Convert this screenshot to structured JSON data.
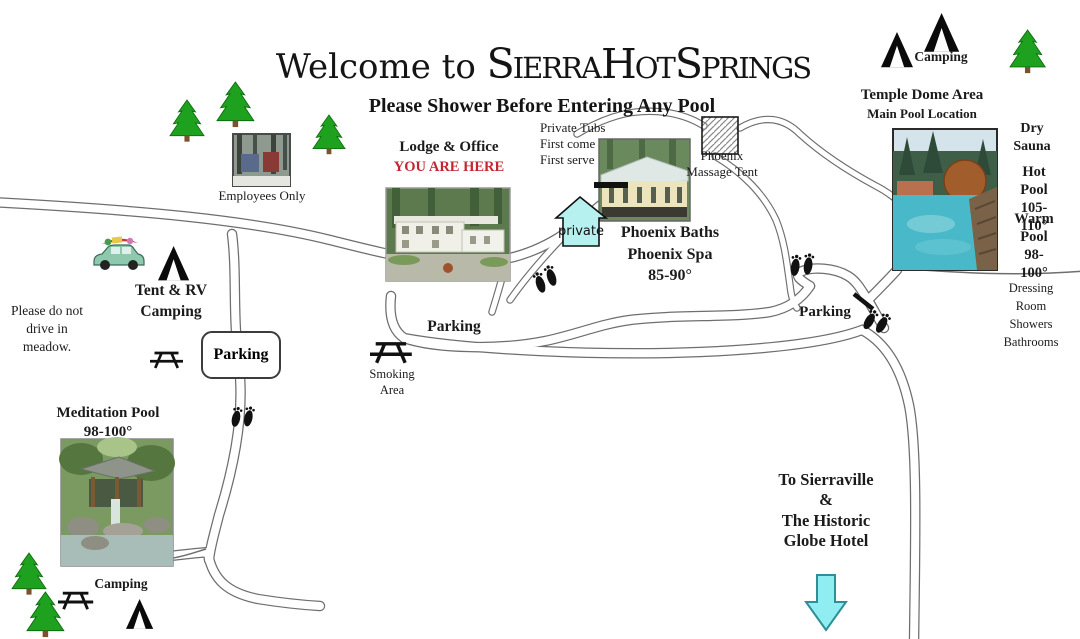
{
  "title": {
    "welcome": "Welcome to ",
    "resort": "Sierra Hot Springs"
  },
  "subtitle": "Please Shower Before Entering Any Pool",
  "areas": {
    "camping_top": "Camping",
    "temple_title": "Temple Dome Area",
    "temple_sub": "Main Pool Location",
    "dry_sauna": "Dry\nSauna",
    "hot_pool": "Hot Pool\n105-110°",
    "warm_pool": "Warm Pool\n98-100°",
    "dressing_rooms": "Dressing Room\nShowers\nBathrooms",
    "private_tubs": "Private Tubs\nFirst come\nFirst serve",
    "massage_tent": "Phoenix\nMassage Tent",
    "private_sign": "private",
    "phoenix_baths": "Phoenix Baths\nPhoenix Spa\n85-90°",
    "lodge_title": "Lodge & Office",
    "lodge_here": "YOU ARE HERE",
    "employees_only": "Employees Only",
    "tent_rv": "Tent & RV\nCamping",
    "meadow_note": "Please do not\ndrive in\nmeadow.",
    "parking_box": "Parking",
    "parking_center": "Parking",
    "parking_right": "Parking",
    "smoking_area": "Smoking\nArea",
    "meditation_pool": "Meditation Pool\n98-100°",
    "camping_bottom": "Camping",
    "sierraville": "To Sierraville\n&\nThe Historic\nGlobe Hotel"
  },
  "icons": {
    "tent_icon": "black tent triangle",
    "pine_tree_icon": "green pine tree",
    "picnic_table_icon": "picnic table",
    "footprints_icon": "walking footprints",
    "massage_tent_icon": "hatched square",
    "private_sign_icon": "cyan house sign",
    "down_arrow_icon": "cyan down arrow",
    "car_icon": "packed camping car",
    "gate_icon": "road gate bar"
  },
  "colors": {
    "accent_red": "#c42531",
    "sign_cyan": "#b6f1ef",
    "arrow_cyan": "#90eef2",
    "arrow_outline": "#2e8f96",
    "tree_green": "#1ea11e",
    "road_gray": "#6e6e6e",
    "text": "#1b1b1b"
  }
}
